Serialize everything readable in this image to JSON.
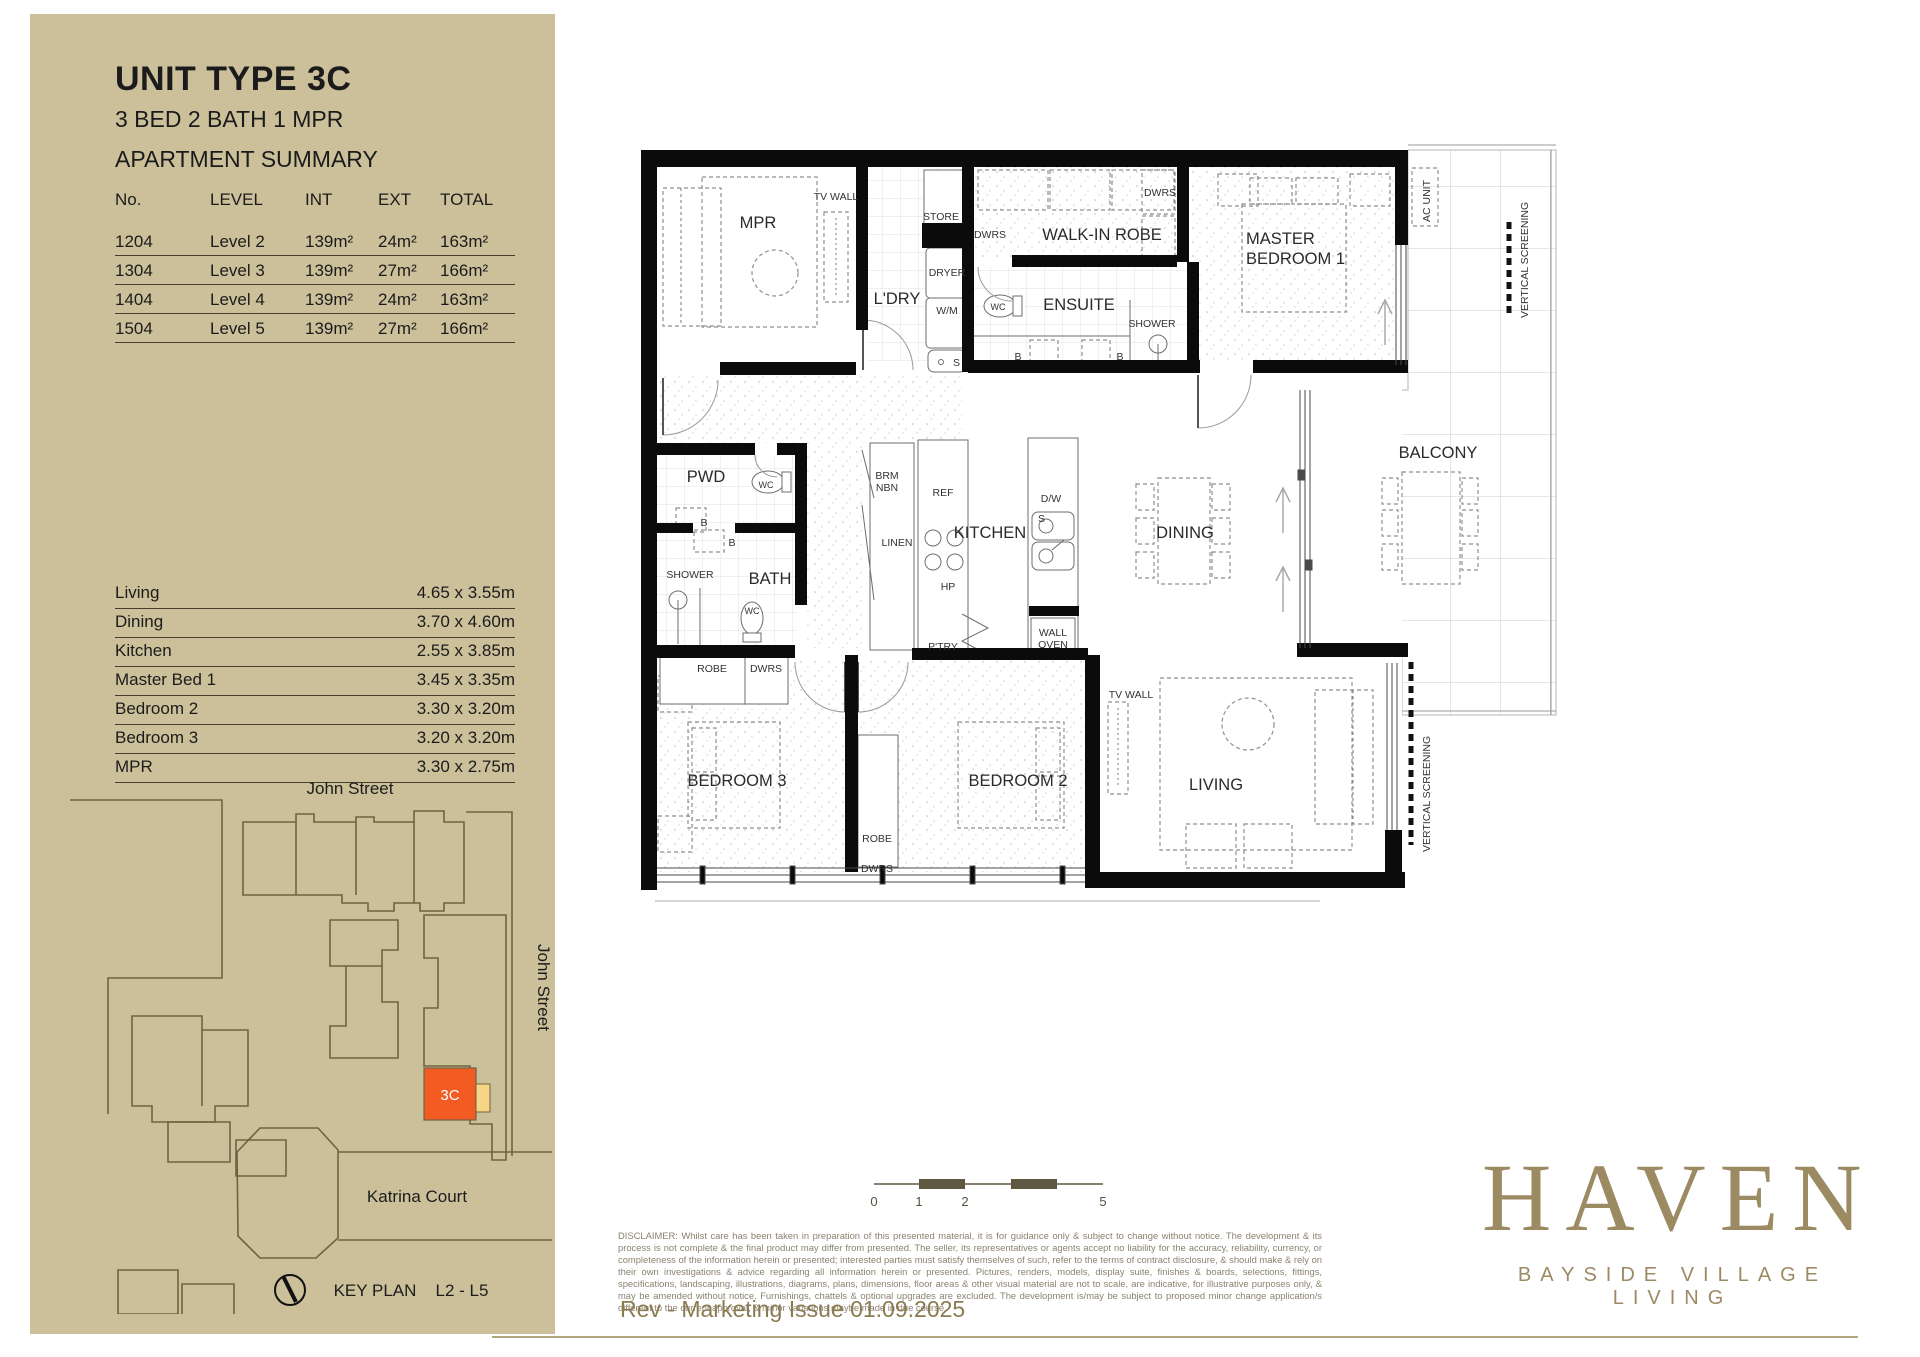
{
  "sidebar": {
    "unit_type": "UNIT TYPE 3C",
    "unit_config": "3 BED 2 BATH 1 MPR",
    "summary_title": "APARTMENT SUMMARY",
    "table": {
      "headers": [
        "No.",
        "LEVEL",
        "INT",
        "EXT",
        "TOTAL"
      ],
      "rows": [
        [
          "1204",
          "Level 2",
          "139m²",
          "24m²",
          "163m²"
        ],
        [
          "1304",
          "Level 3",
          "139m²",
          "27m²",
          "166m²"
        ],
        [
          "1404",
          "Level 4",
          "139m²",
          "24m²",
          "163m²"
        ],
        [
          "1504",
          "Level 5",
          "139m²",
          "27m²",
          "166m²"
        ]
      ]
    },
    "dimensions": [
      {
        "label": "Living",
        "value": "4.65 x 3.55m"
      },
      {
        "label": "Dining",
        "value": "3.70 x 4.60m"
      },
      {
        "label": "Kitchen",
        "value": "2.55 x 3.85m"
      },
      {
        "label": "Master Bed 1",
        "value": "3.45 x 3.35m"
      },
      {
        "label": "Bedroom 2",
        "value": "3.30 x 3.20m"
      },
      {
        "label": "Bedroom 3",
        "value": "3.20 x 3.20m"
      },
      {
        "label": "MPR",
        "value": "3.30 x 2.75m"
      }
    ],
    "key_plan": {
      "street_top": "John Street",
      "street_right": "John Street",
      "court": "Katrina Court",
      "unit_label": "3C",
      "label": "KEY PLAN",
      "levels": "L2 - L5",
      "unit_color": "#f25c22",
      "balcony_color": "#f8d485"
    }
  },
  "plan": {
    "labels": {
      "mpr": "MPR",
      "tv_wall": "TV WALL",
      "ldry": "L'DRY",
      "store": "STORE",
      "dwrs": "DWRS",
      "dryer": "DRYER",
      "wm": "W/M",
      "s": "S",
      "wir": "WALK-IN ROBE",
      "ensuite": "ENSUITE",
      "wc": "WC",
      "b": "B",
      "shower": "SHOWER",
      "master_1": "MASTER",
      "master_2": "BEDROOM 1",
      "ac_unit": "AC UNIT",
      "vertical_screening": "VERTICAL SCREENING",
      "balcony": "BALCONY",
      "pwd": "PWD",
      "bath": "BATH",
      "brm": "BRM",
      "nbn": "NBN",
      "linen": "LINEN",
      "ref": "REF",
      "kitchen": "KITCHEN",
      "dw": "D/W",
      "hp": "HP",
      "ptry": "P'TRY",
      "wall_oven_1": "WALL",
      "wall_oven_2": "OVEN",
      "dining": "DINING",
      "bedroom3": "BEDROOM 3",
      "robe": "ROBE",
      "bedroom2": "BEDROOM 2",
      "living": "LIVING"
    },
    "scale_ticks": [
      "0",
      "1",
      "2",
      "5"
    ]
  },
  "footer": {
    "disclaimer": "DISCLAIMER: Whilst care has been taken in preparation of this presented material, it is for guidance only & subject to change without notice. The development & its process is not complete & the final product may differ from presented. The seller, its representatives or agents accept no liability for the accuracy, reliability, currency, or completeness of the information herein or presented; interested parties must satisfy themselves of such, refer to the terms of contract disclosure, & should make & rely on their own investigations & advice regarding all information herein or presented. Pictures, renders, models, display suite, finishes & boards, selections, fittings, specifications, landscaping, illustrations, diagrams, plans, dimensions, floor areas & other visual material are not to scale, are indicative, for illustrative purposes only, & may be amended without notice. Furnishings, chattels & optional upgrades are excluded. The development is/may be subject to proposed minor change application/s different to the current approval, & minor variations maybe made in due course.",
    "rev": "Rev -  Marketing Issue  01.09.2025",
    "logo": "HAVEN",
    "tagline": "BAYSIDE VILLAGE LIVING"
  }
}
